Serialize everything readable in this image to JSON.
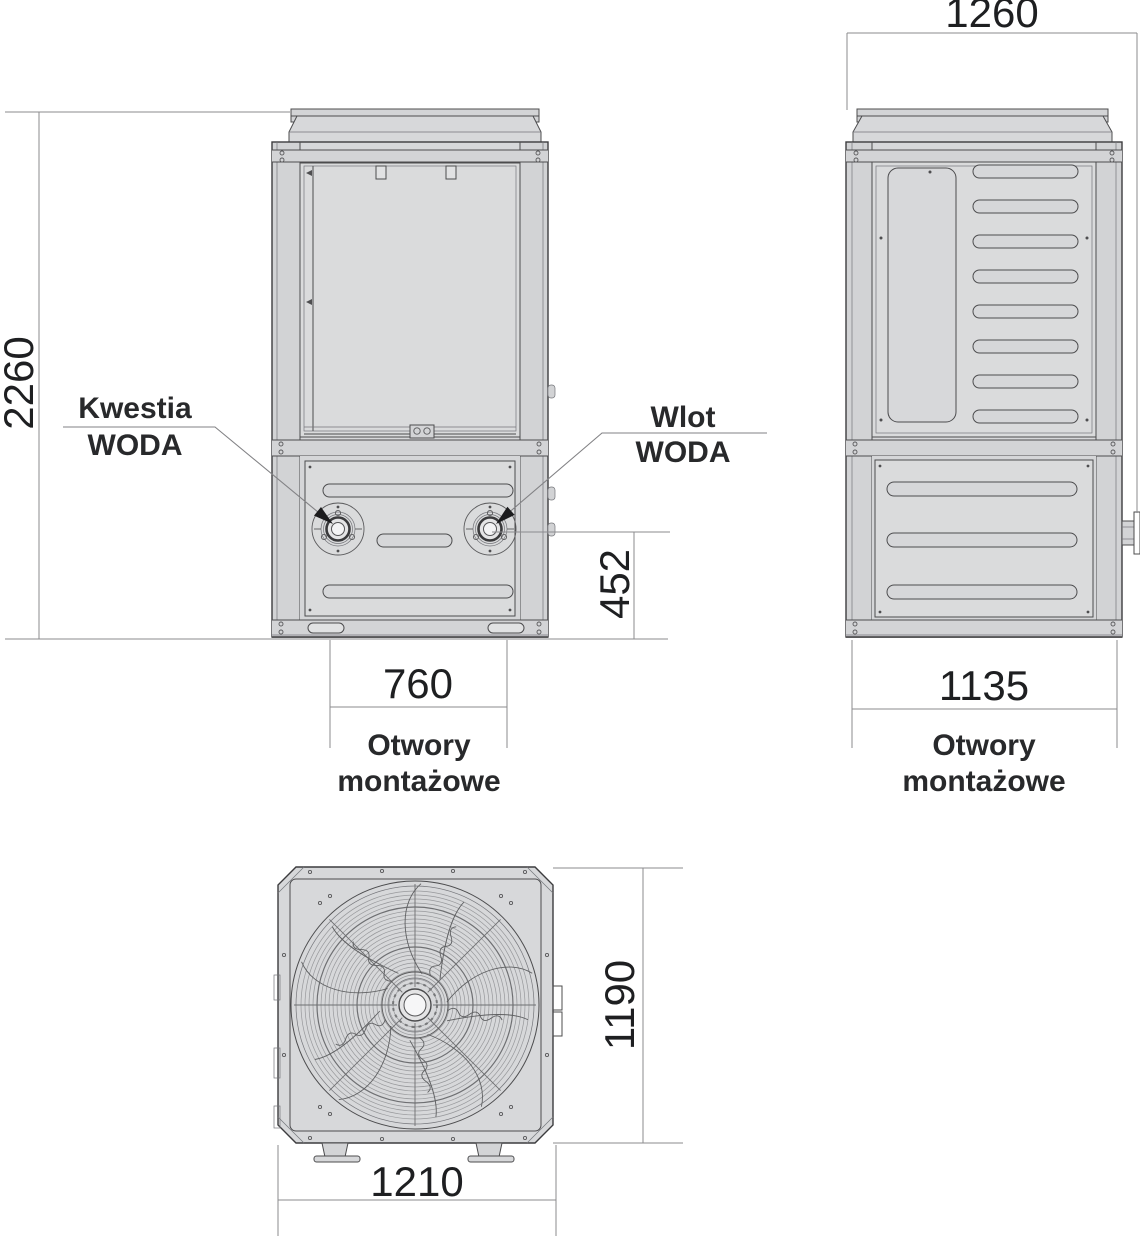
{
  "front_view": {
    "height_dim": "2260",
    "water_height_dim": "452",
    "mounting_dim": "760",
    "mounting_label": [
      "Otwory",
      "montażowe"
    ],
    "outlet_label": [
      "Kwestia",
      "WODA"
    ],
    "inlet_label": [
      "Wlot",
      "WODA"
    ]
  },
  "side_view": {
    "width_dim": "1260",
    "mounting_dim": "1135",
    "mounting_label": [
      "Otwory",
      "montażowe"
    ]
  },
  "top_view": {
    "height_dim": "1190",
    "width_dim": "1210"
  },
  "colors": {
    "body_fill": "#d7d8da",
    "panel_fill": "#dadbdc",
    "outline": "#4c4c4e",
    "dimension_line": "#8b8b8e",
    "text": "#1e1f21"
  }
}
